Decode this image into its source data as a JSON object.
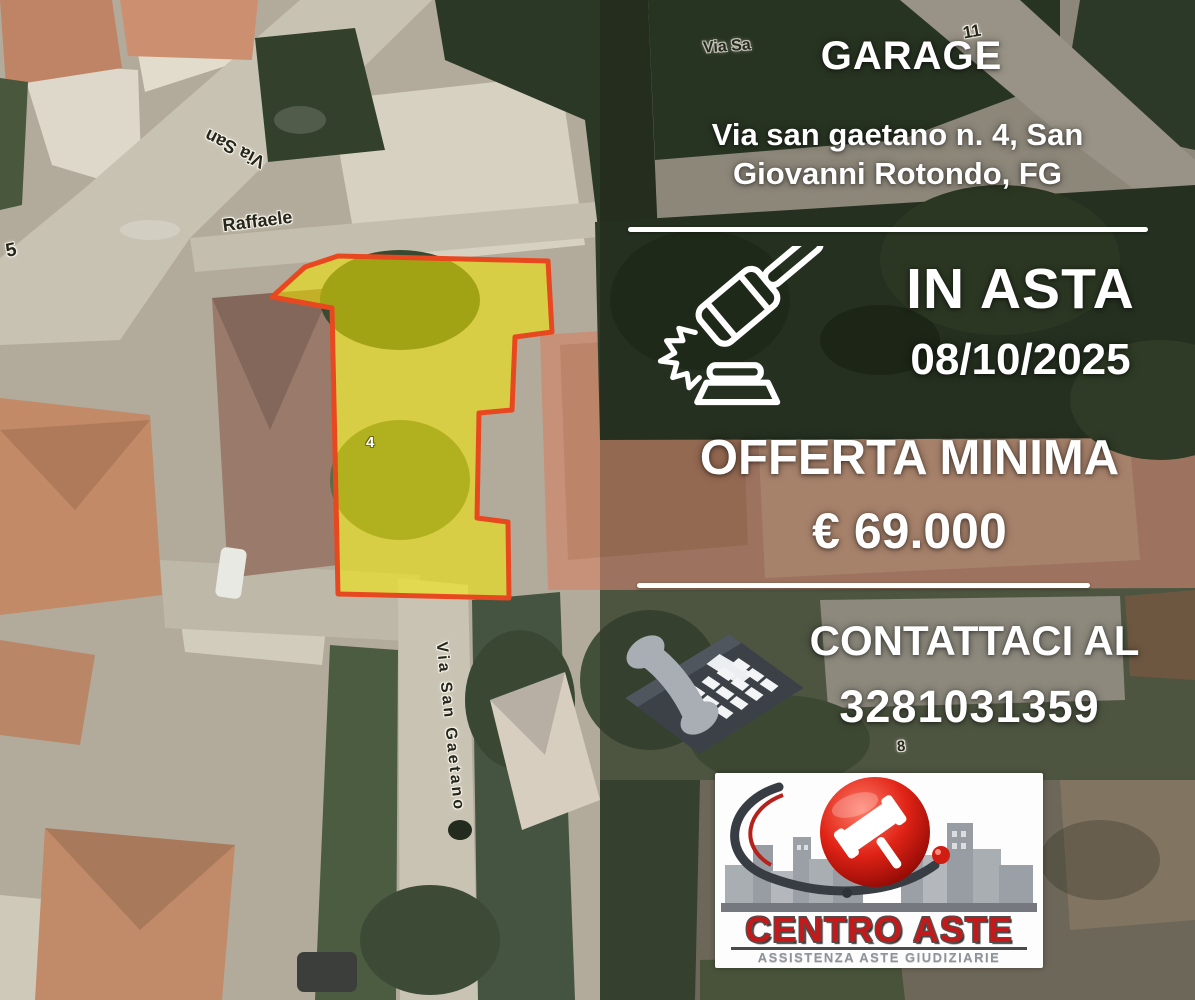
{
  "map": {
    "labels": {
      "via_san": "Via San",
      "raffaele": "Raffaele",
      "house_number_5": "5",
      "via_sa": "Via Sa",
      "house_number_11": "11",
      "house_number_8": "8",
      "via_san_gaetano": "Via San Gaetano",
      "parcel_number": "4"
    },
    "parcel": {
      "fill": "rgba(247,235,0,0.55)",
      "stroke": "#e8481f"
    }
  },
  "panel": {
    "title": "GARAGE",
    "address_line1": "Via san gaetano n. 4, San",
    "address_line2": "Giovanni Rotondo, FG",
    "auction": {
      "status": "IN ASTA",
      "date": "08/10/2025"
    },
    "offer": {
      "label": "OFFERTA MINIMA",
      "amount": "€ 69.000"
    },
    "contact": {
      "label": "CONTATTACI AL",
      "phone": "3281031359"
    },
    "logo": {
      "name": "CENTRO ASTE",
      "tagline": "ASSISTENZA ASTE GIUDIZIARIE"
    },
    "colors": {
      "text": "#ffffff",
      "divider": "#ffffff",
      "logo_red": "#c21a1a",
      "logo_gray": "#8e9399",
      "phone_icon": "#3c4148",
      "gavel_icon": "#ffffff"
    }
  }
}
